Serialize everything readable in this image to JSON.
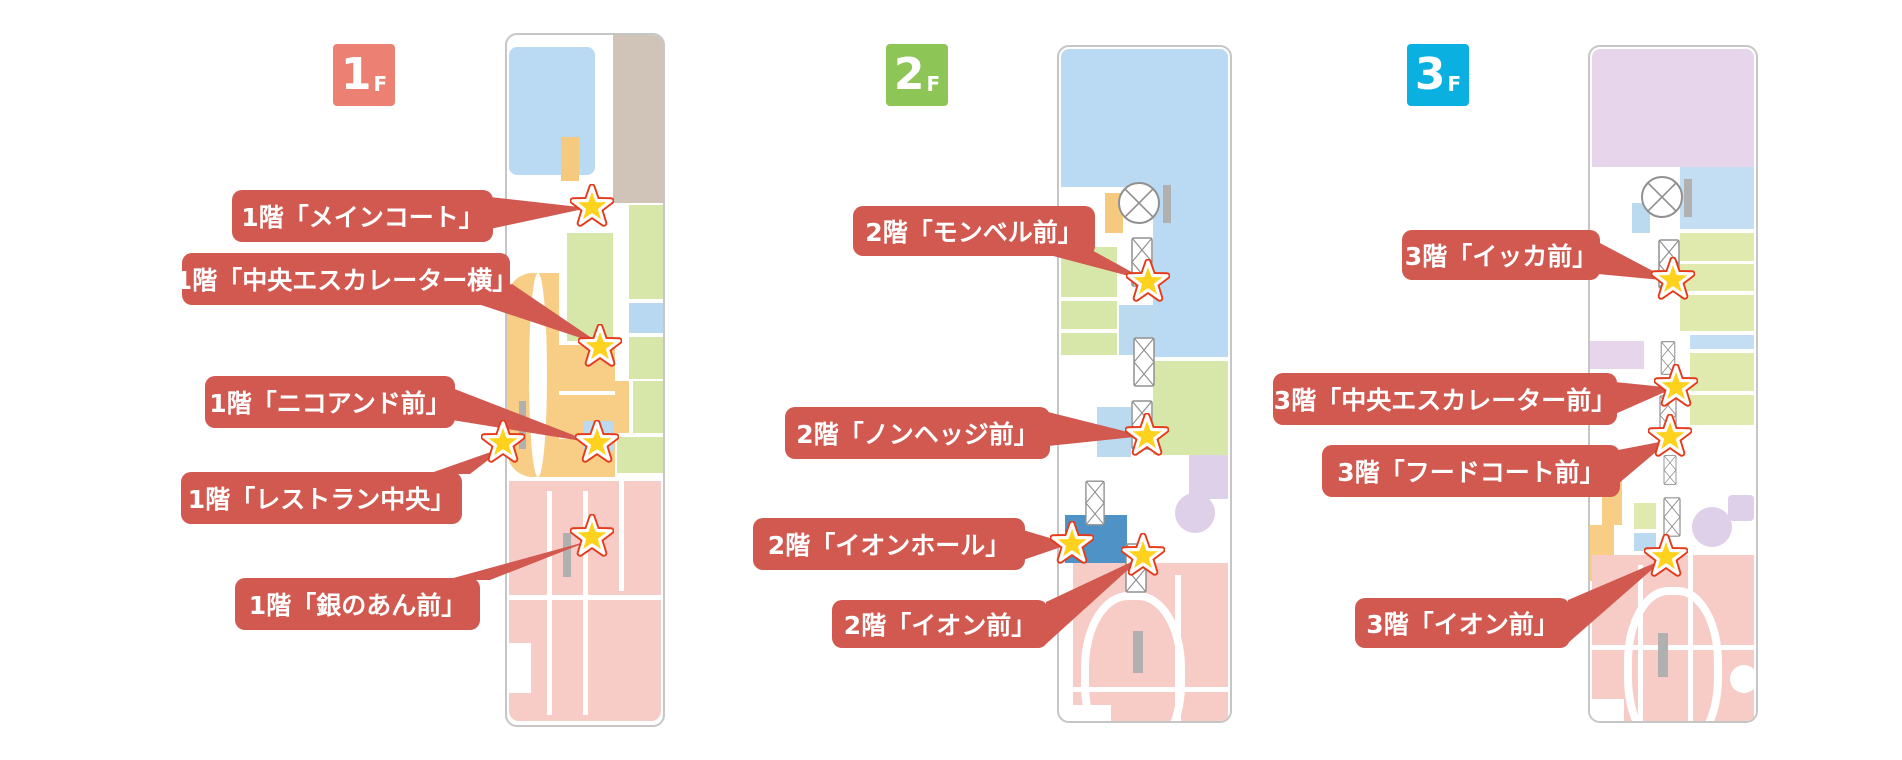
{
  "colors": {
    "callout_bg": "#d25950",
    "callout_text": "#ffffff",
    "star_fill": "#ffd21e",
    "star_outline": "#e63a1a",
    "badge_1f": "#ec8173",
    "badge_2f": "#8dc556",
    "badge_3f": "#0ab1e0",
    "map_aeon_pink": "#f8ccc6",
    "map_restaurant_orange": "#f8cd85",
    "aeon_hall_blue": "#4e92c6"
  },
  "floors": [
    {
      "badge": {
        "number": "1",
        "suffix": "F"
      },
      "callouts": [
        "1階「メインコート」",
        "1階「中央エスカレーター横」",
        "1階「ニコアンド前」",
        "1階「レストラン中央」",
        "1階「銀のあん前」"
      ]
    },
    {
      "badge": {
        "number": "2",
        "suffix": "F"
      },
      "callouts": [
        "2階「モンベル前」",
        "2階「ノンヘッジ前」",
        "2階「イオンホール」",
        "2階「イオン前」"
      ]
    },
    {
      "badge": {
        "number": "3",
        "suffix": "F"
      },
      "callouts": [
        "3階「イッカ前」",
        "3階「中央エスカレーター前」",
        "3階「フードコート前」",
        "3階「イオン前」"
      ]
    }
  ]
}
